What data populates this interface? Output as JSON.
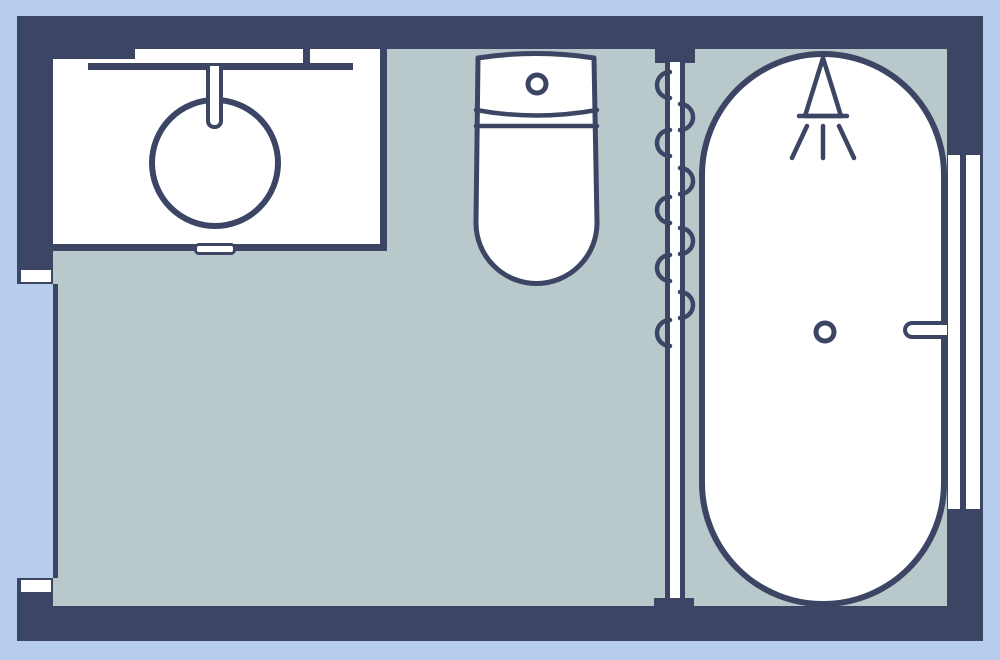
{
  "diagram": {
    "type": "floor-plan",
    "room": "bathroom",
    "fixtures": [
      "vanity-counter-with-round-sink",
      "faucet",
      "vanity-drawer-handle",
      "toilet-with-tank-and-flush-button",
      "shower-curtain-rail-with-loops",
      "oval-bathtub",
      "shower-head-icon",
      "bathtub-drain",
      "bathtub-grab-handle",
      "right-wall-window-two-panes",
      "left-wall-door-opening-with-jambs"
    ]
  },
  "colors": {
    "wall": "#3d4565",
    "floor": "#b9c8ca",
    "outside": "#b7cdee",
    "fixture": "#ffffff"
  }
}
